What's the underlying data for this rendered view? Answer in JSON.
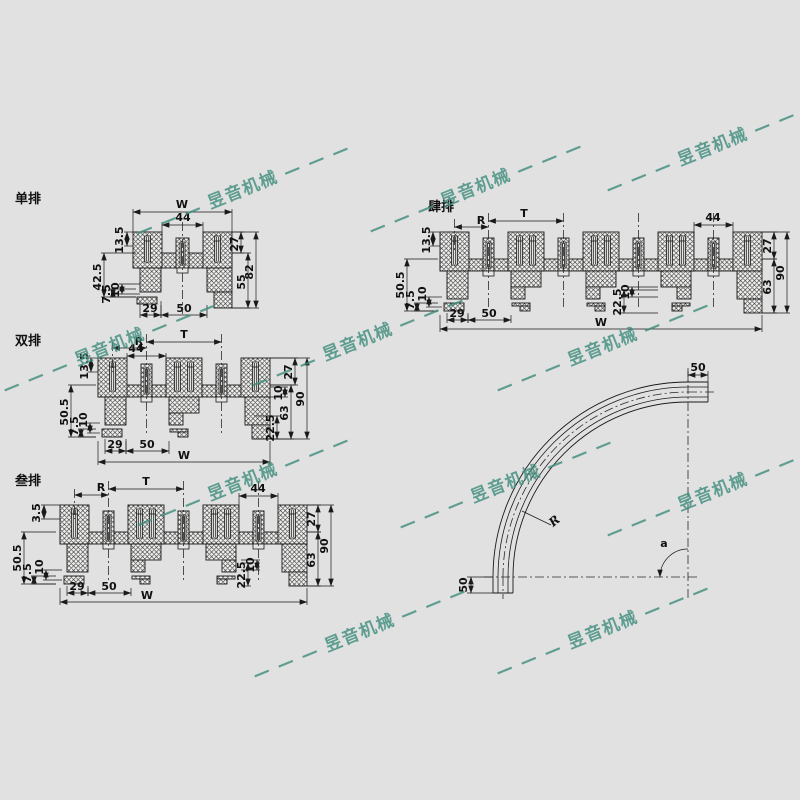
{
  "page": {
    "background": "#e1e1e1",
    "line_color": "#1a1a1a",
    "watermark_color": "#3e8d7c"
  },
  "watermark": {
    "text": "昱音机械",
    "dashes": "— — —"
  },
  "views": {
    "single": {
      "title": "单排",
      "dims": {
        "overall": "W",
        "track": "44",
        "top_offset": "13.5",
        "block_h": "27",
        "body_h": "55",
        "total_h": "82",
        "side": "42.5",
        "slot": "7.5",
        "offset": "10",
        "leg": "29",
        "opening": "50"
      }
    },
    "double": {
      "title": "双排",
      "dims": {
        "pitch": "T",
        "radius_ref": "R",
        "track": "44",
        "top_offset": "13.5",
        "side": "50.5",
        "slot": "7.5",
        "offset": "10",
        "block_h": "27",
        "offset_r": "10",
        "body_h": "63",
        "total_h": "90",
        "foot": "22.5",
        "leg": "29",
        "opening": "50",
        "overall": "W"
      }
    },
    "triple": {
      "title": "叁排",
      "dims": {
        "pitch": "T",
        "radius_ref": "R",
        "track": "44",
        "top_offset": "3.5",
        "side": "50.5",
        "slot": "7.5",
        "offset": "10",
        "block_h": "27",
        "offset_r": "10",
        "body_h": "63",
        "total_h": "90",
        "foot": "22.5",
        "leg": "29",
        "opening": "50",
        "overall": "W"
      }
    },
    "quad": {
      "title": "肆排",
      "dims": {
        "pitch": "T",
        "radius_ref": "R",
        "track": "44",
        "top_offset": "13.5",
        "side": "50.5",
        "slot": "7.5",
        "offset": "10",
        "block_h": "27",
        "offset_r": "10",
        "body_h": "63",
        "total_h": "90",
        "foot": "22.5",
        "leg": "29",
        "opening": "50",
        "overall": "W"
      }
    },
    "curve": {
      "labels": {
        "ext_top": "50",
        "ext_side": "50",
        "radius": "R",
        "angle": "a"
      }
    }
  }
}
